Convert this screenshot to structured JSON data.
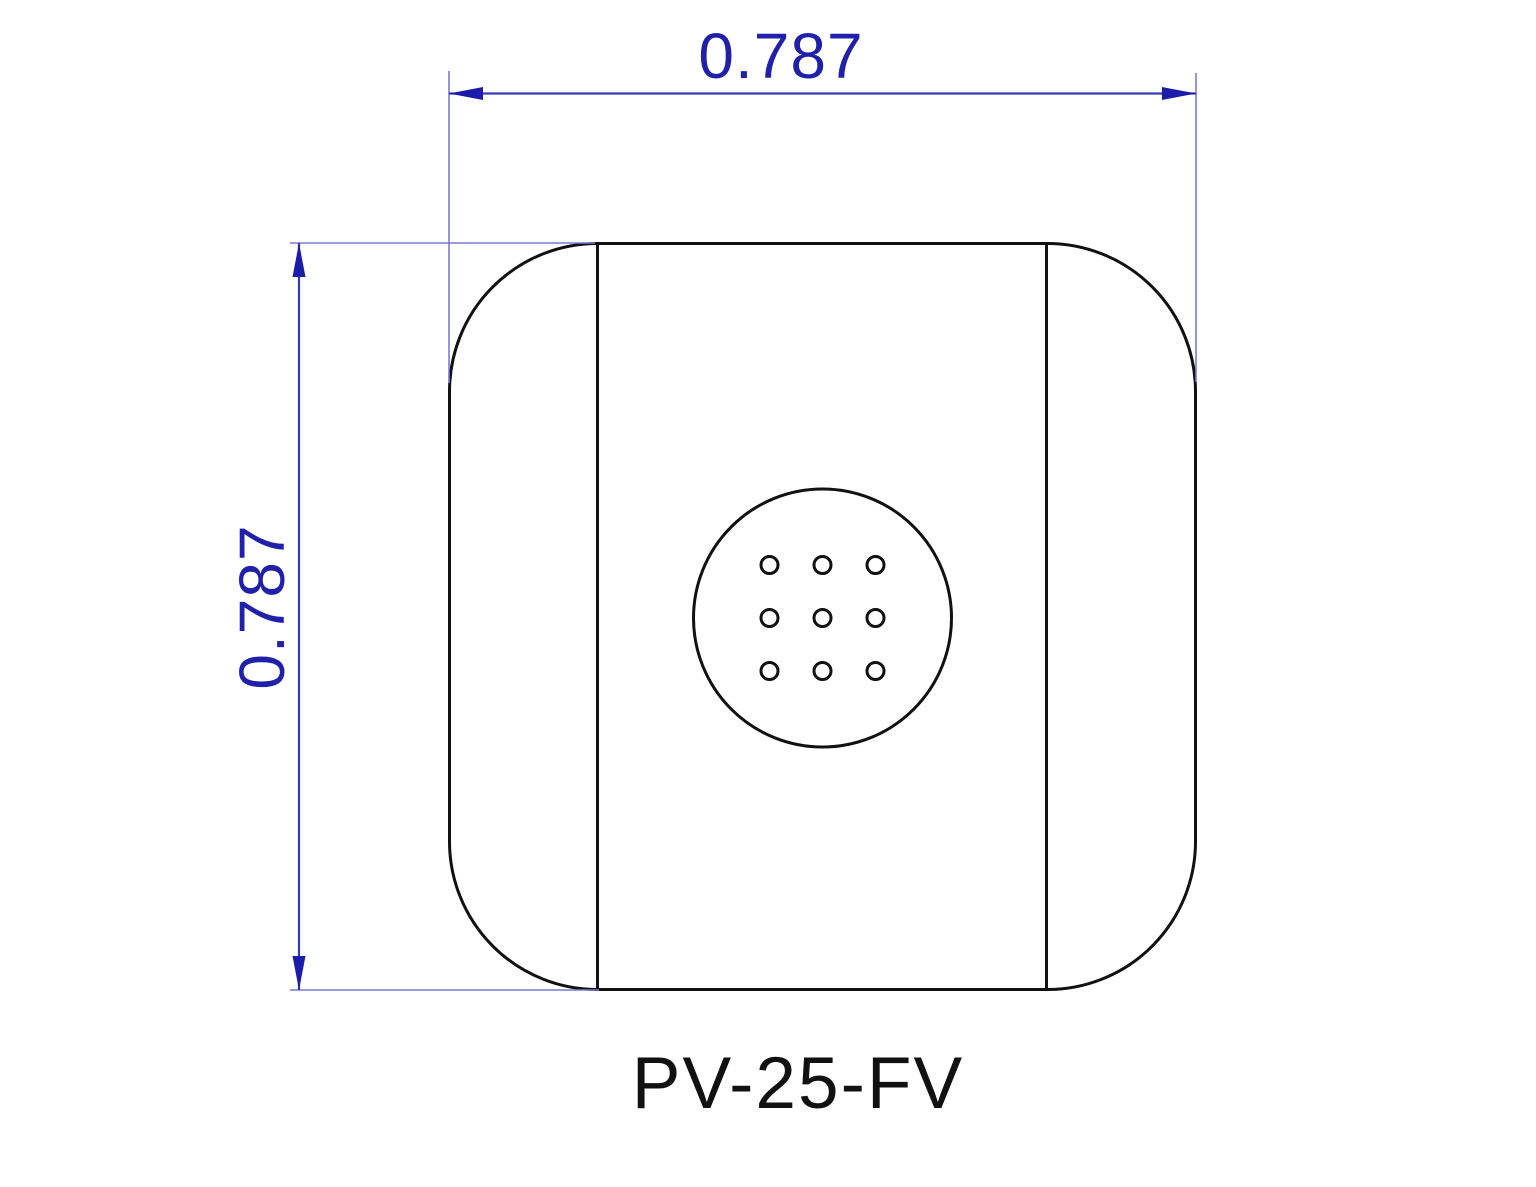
{
  "drawing": {
    "part_label": "PV-25-FV",
    "dim_width": {
      "label": "0.787"
    },
    "dim_height": {
      "label": "0.787"
    },
    "features": {
      "outline_shape": "rounded-square",
      "center_circle": true,
      "hole_grid_rows": 3,
      "hole_grid_cols": 3,
      "arrowhead_style": "filled-triangle"
    },
    "colors": {
      "dimension_text": "#2020aa",
      "dimension_line": "#3a3ab8",
      "extension_line": "#7b7bce",
      "arrow": "#1c1caa",
      "outline": "#111111",
      "label": "#111111",
      "background": "#ffffff"
    }
  }
}
